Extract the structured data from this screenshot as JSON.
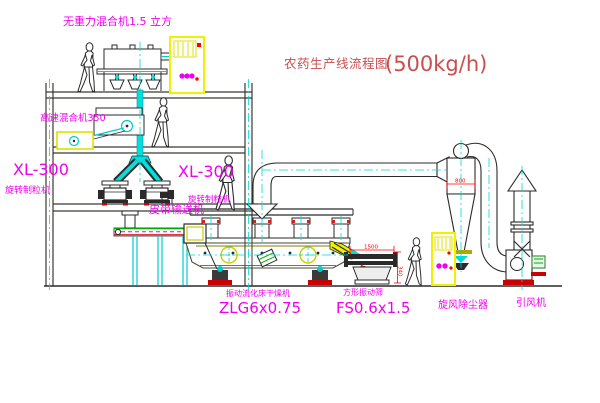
{
  "title": {
    "text": "农药生产线流程图",
    "capacity": "(500kg/h)"
  },
  "equipment_labels": {
    "gravity_free_mixer": "无重力混合机1.5 立方",
    "high_speed_mixer": "高速混合机350",
    "granulator_left": {
      "model": "XL-300",
      "name": "旋转制粒机"
    },
    "granulator_right": {
      "model": "XL-300",
      "name": "旋转制粒机"
    },
    "belt_conveyor": "皮带输送机",
    "fluid_bed_dryer": {
      "name": "振动流化床干燥机",
      "model": "ZLG6x0.75"
    },
    "vibrating_sieve": {
      "name": "方形振动筛",
      "model": "FS0.6x1.5"
    },
    "cyclone": "旋风除尘器",
    "induced_draft_fan": "引风机"
  },
  "dimensions": {
    "sieve_length": "1500",
    "sieve_height": "340",
    "cyclone_diameter": "800"
  },
  "colors": {
    "label_magenta": "#f000f0",
    "title_red": "#c94f4f",
    "dimension_red": "#ff0000",
    "cabinet_yellow": "#f0f000",
    "pipe_cyan": "#00e0e0",
    "conveyor_green": "#00aa00",
    "line_dark": "#2e2e28",
    "olive": "#808000"
  }
}
